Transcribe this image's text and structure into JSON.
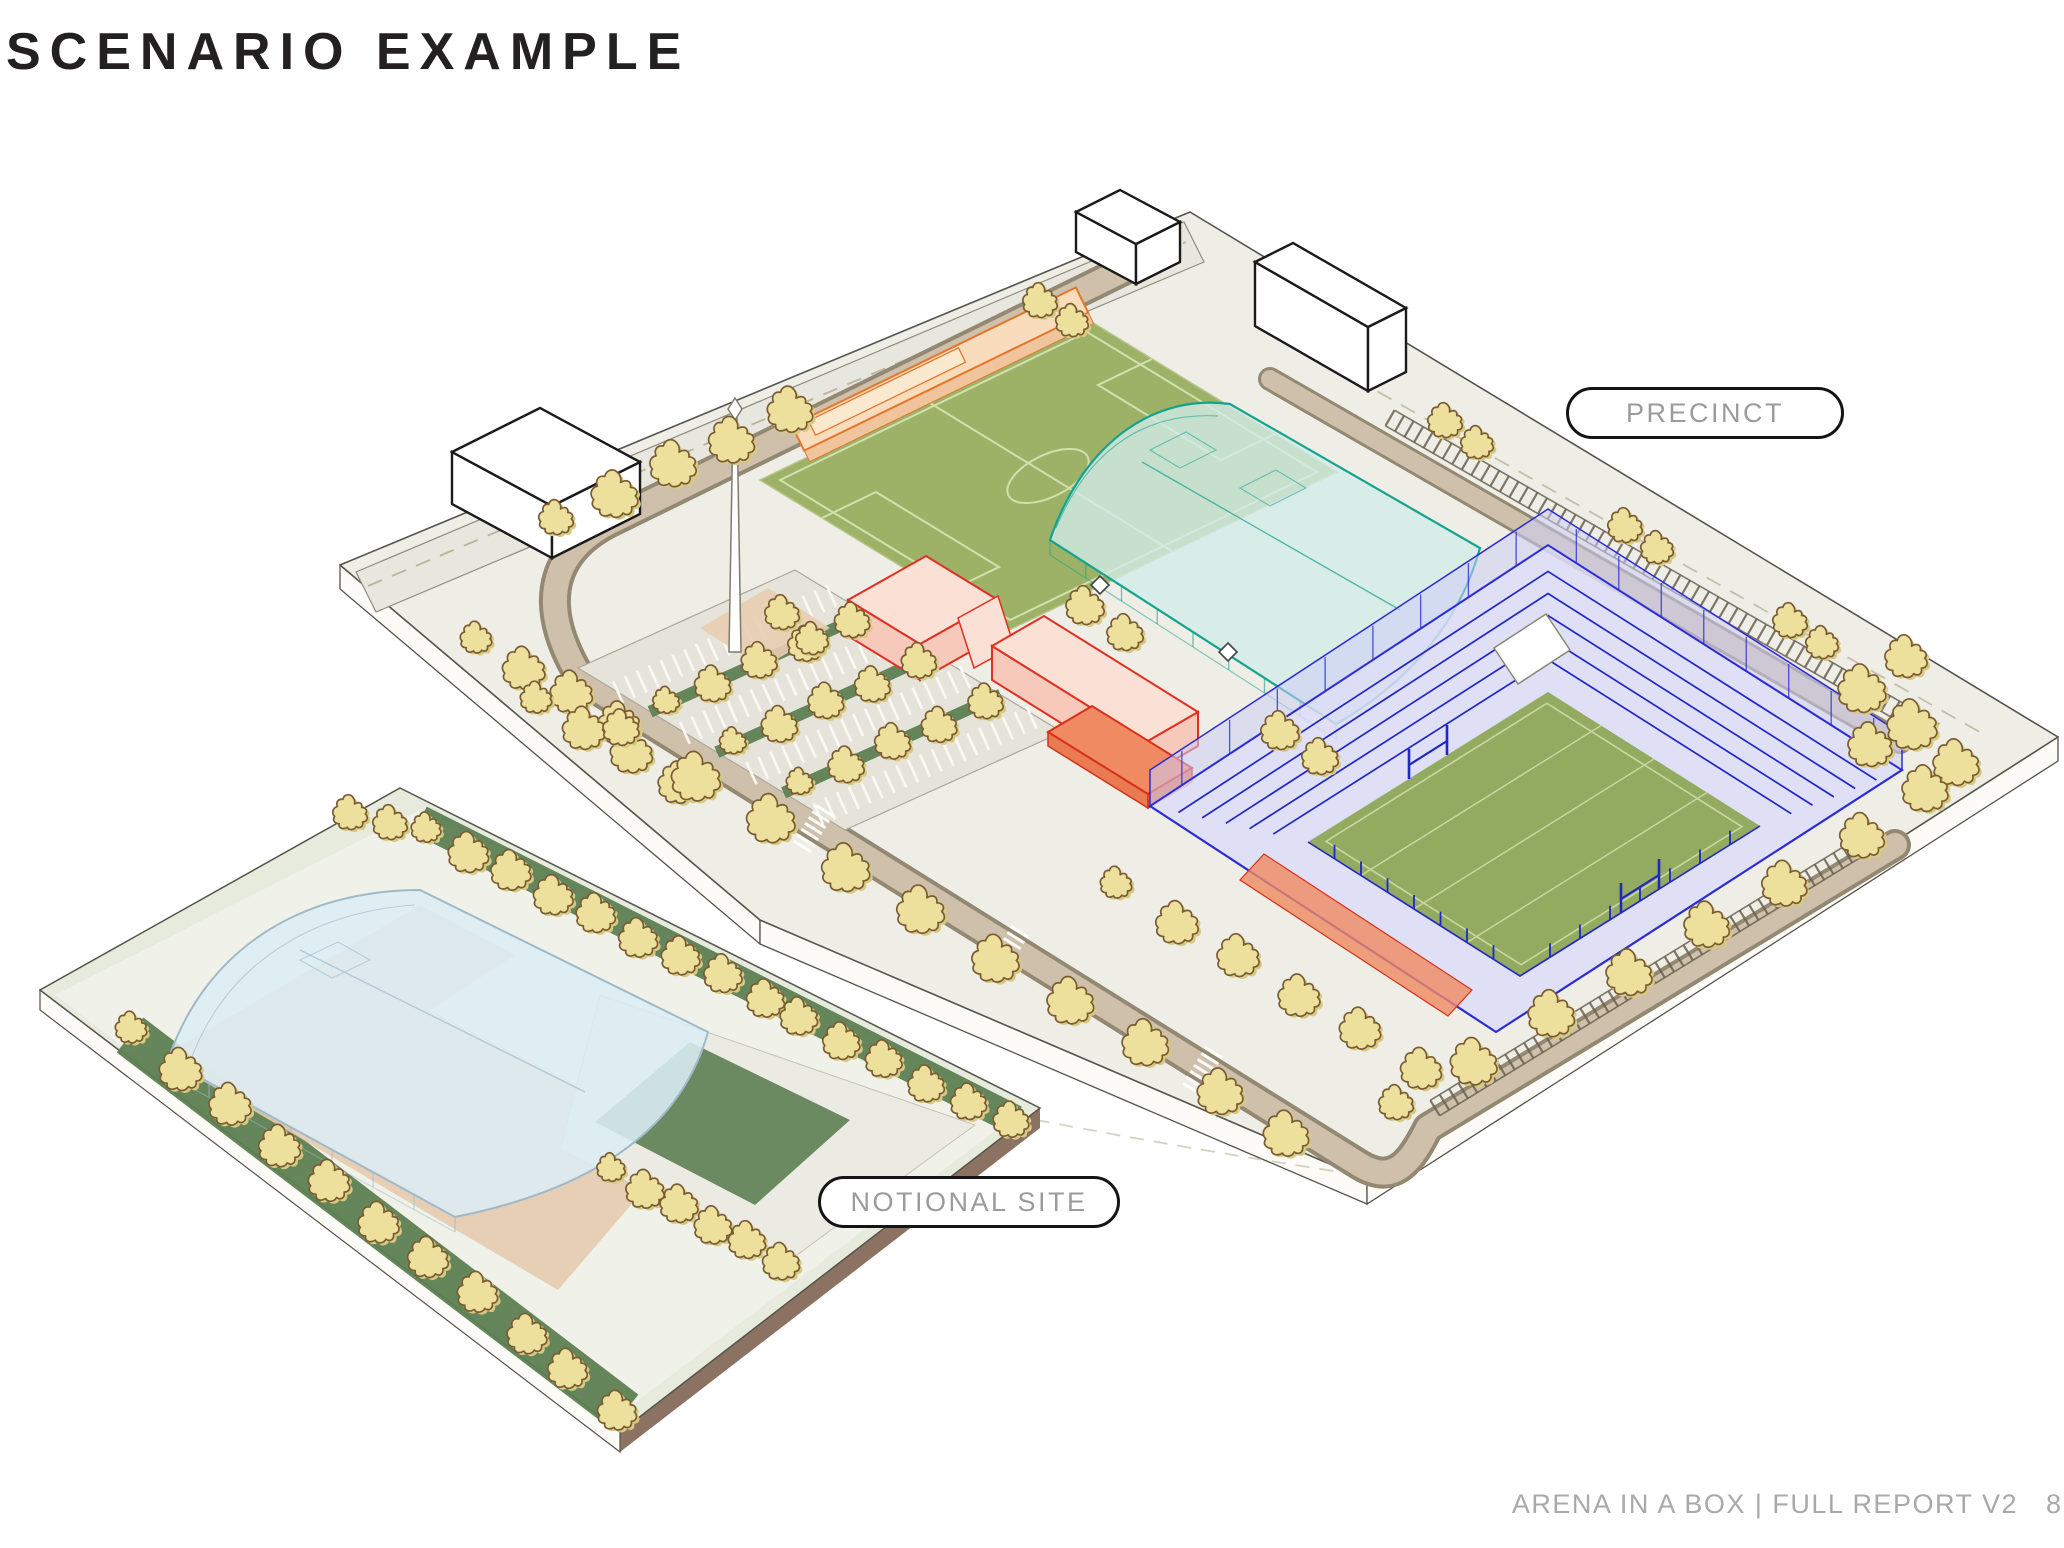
{
  "page": {
    "title": "SCENARIO EXAMPLE",
    "footer": "ARENA IN A BOX | FULL REPORT V2",
    "page_number": "8"
  },
  "labels": {
    "precinct": "PRECINCT",
    "notional_site": "NOTIONAL SITE"
  },
  "diagram": {
    "type": "isometric-architectural-site-diagram",
    "views": [
      {
        "name": "precinct",
        "label": "PRECINCT",
        "elements": [
          "blue-stadium-with-rugby-pitch",
          "teal-indoor-arena",
          "green-training-pitch",
          "orange-pavilion-building",
          "red-mixed-use-buildings",
          "terracotta-pavilion",
          "surface-car-park",
          "rail-corridor",
          "perimeter-roads",
          "street-trees",
          "obelisk-landmark",
          "white-context-buildings"
        ]
      },
      {
        "name": "notional-site",
        "label": "NOTIONAL SITE",
        "elements": [
          "pale-blue-indoor-arena",
          "lawn-strips",
          "tan-plaza",
          "paths",
          "street-trees"
        ]
      }
    ]
  },
  "colors": {
    "background": "#ffffff",
    "title_text": "#232021",
    "pill_text": "#9b9b9b",
    "pill_border": "#141414",
    "footer_text": "#a9a9a9",
    "plate_fill": "#eeede6",
    "plate_stroke": "#55544a",
    "plinth_fill": "#fcfbf7",
    "road_gray": "#e7e6df",
    "road_edge": "#8f8d7e",
    "road_tan_dark": "#938871",
    "road_tan_light": "#cfc0ab",
    "rail_dark": "#6a6151",
    "dash_olive": "#b8b598",
    "field_green": "#9db267",
    "field_line": "#d3e0ae",
    "parking_fill": "#e6e4da",
    "parking_stroke": "#aaa79a",
    "hatch_white": "#fbfaf4",
    "median_green": "#5d8052",
    "tree_fill": "#ece09c",
    "tree_shadow": "#d8ca80",
    "tree_stroke": "#7a5c34",
    "orange_fill": "#f9dcbc",
    "orange_wall": "#f0c49c",
    "orange_stroke": "#e4762b",
    "red_stroke": "#e03020",
    "red_fill": "#fbe0d6",
    "red_wall": "#f6c9bb",
    "terracotta_fill": "#ef8a62",
    "terracotta_dark": "#e97a52",
    "teal_fill": "#d2ebe8",
    "teal_stroke": "#14a38f",
    "stadium_fill": "#dcdcf7",
    "stadium_stroke": "#2b2bd4",
    "seating_blue": "#2026c8",
    "stand_fill": "#cdcdf5",
    "pitch_green": "#93ab61",
    "pitch_line": "#c8d8a0",
    "notional_plate": "#e6ebdd",
    "notional_panel": "#f0f1e9",
    "lawn_green": "#5d8052",
    "plaza_tan": "#e5cbb0",
    "path_gray": "#ecebe3",
    "notional_arena_fill": "#dcedf4",
    "notional_arena_stroke": "#9fb9c9",
    "plinth_brown": "#8b7262",
    "context_stroke": "#1a1a1a",
    "white": "#ffffff"
  }
}
